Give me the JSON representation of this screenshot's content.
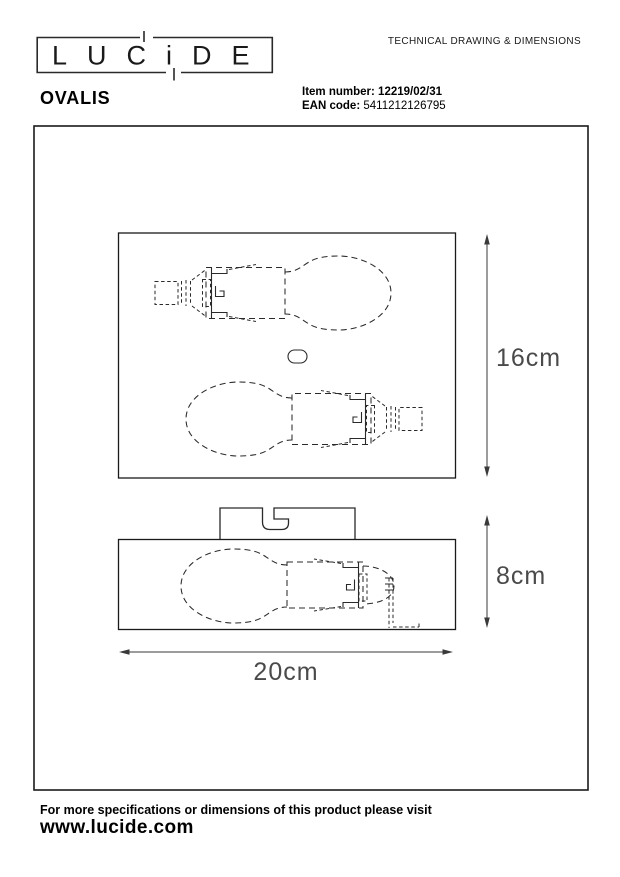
{
  "header": {
    "logo_text": "LUCiDE",
    "doc_title": "TECHNICAL DRAWING & DIMENSIONS",
    "product_name": "OVALIS",
    "item_number_label": "Item number:",
    "item_number_value": "12219/02/31",
    "ean_label": "EAN code:",
    "ean_value": "5411212126795"
  },
  "drawing": {
    "dimensions": {
      "height": "16cm",
      "depth": "8cm",
      "width": "20cm"
    }
  },
  "footer": {
    "note": "For more specifications or dimensions of this product please visit",
    "website": "www.lucide.com"
  },
  "colors": {
    "background": "#ffffff",
    "line": "#1a1a1a",
    "dimension_text": "#4a4a4a"
  }
}
